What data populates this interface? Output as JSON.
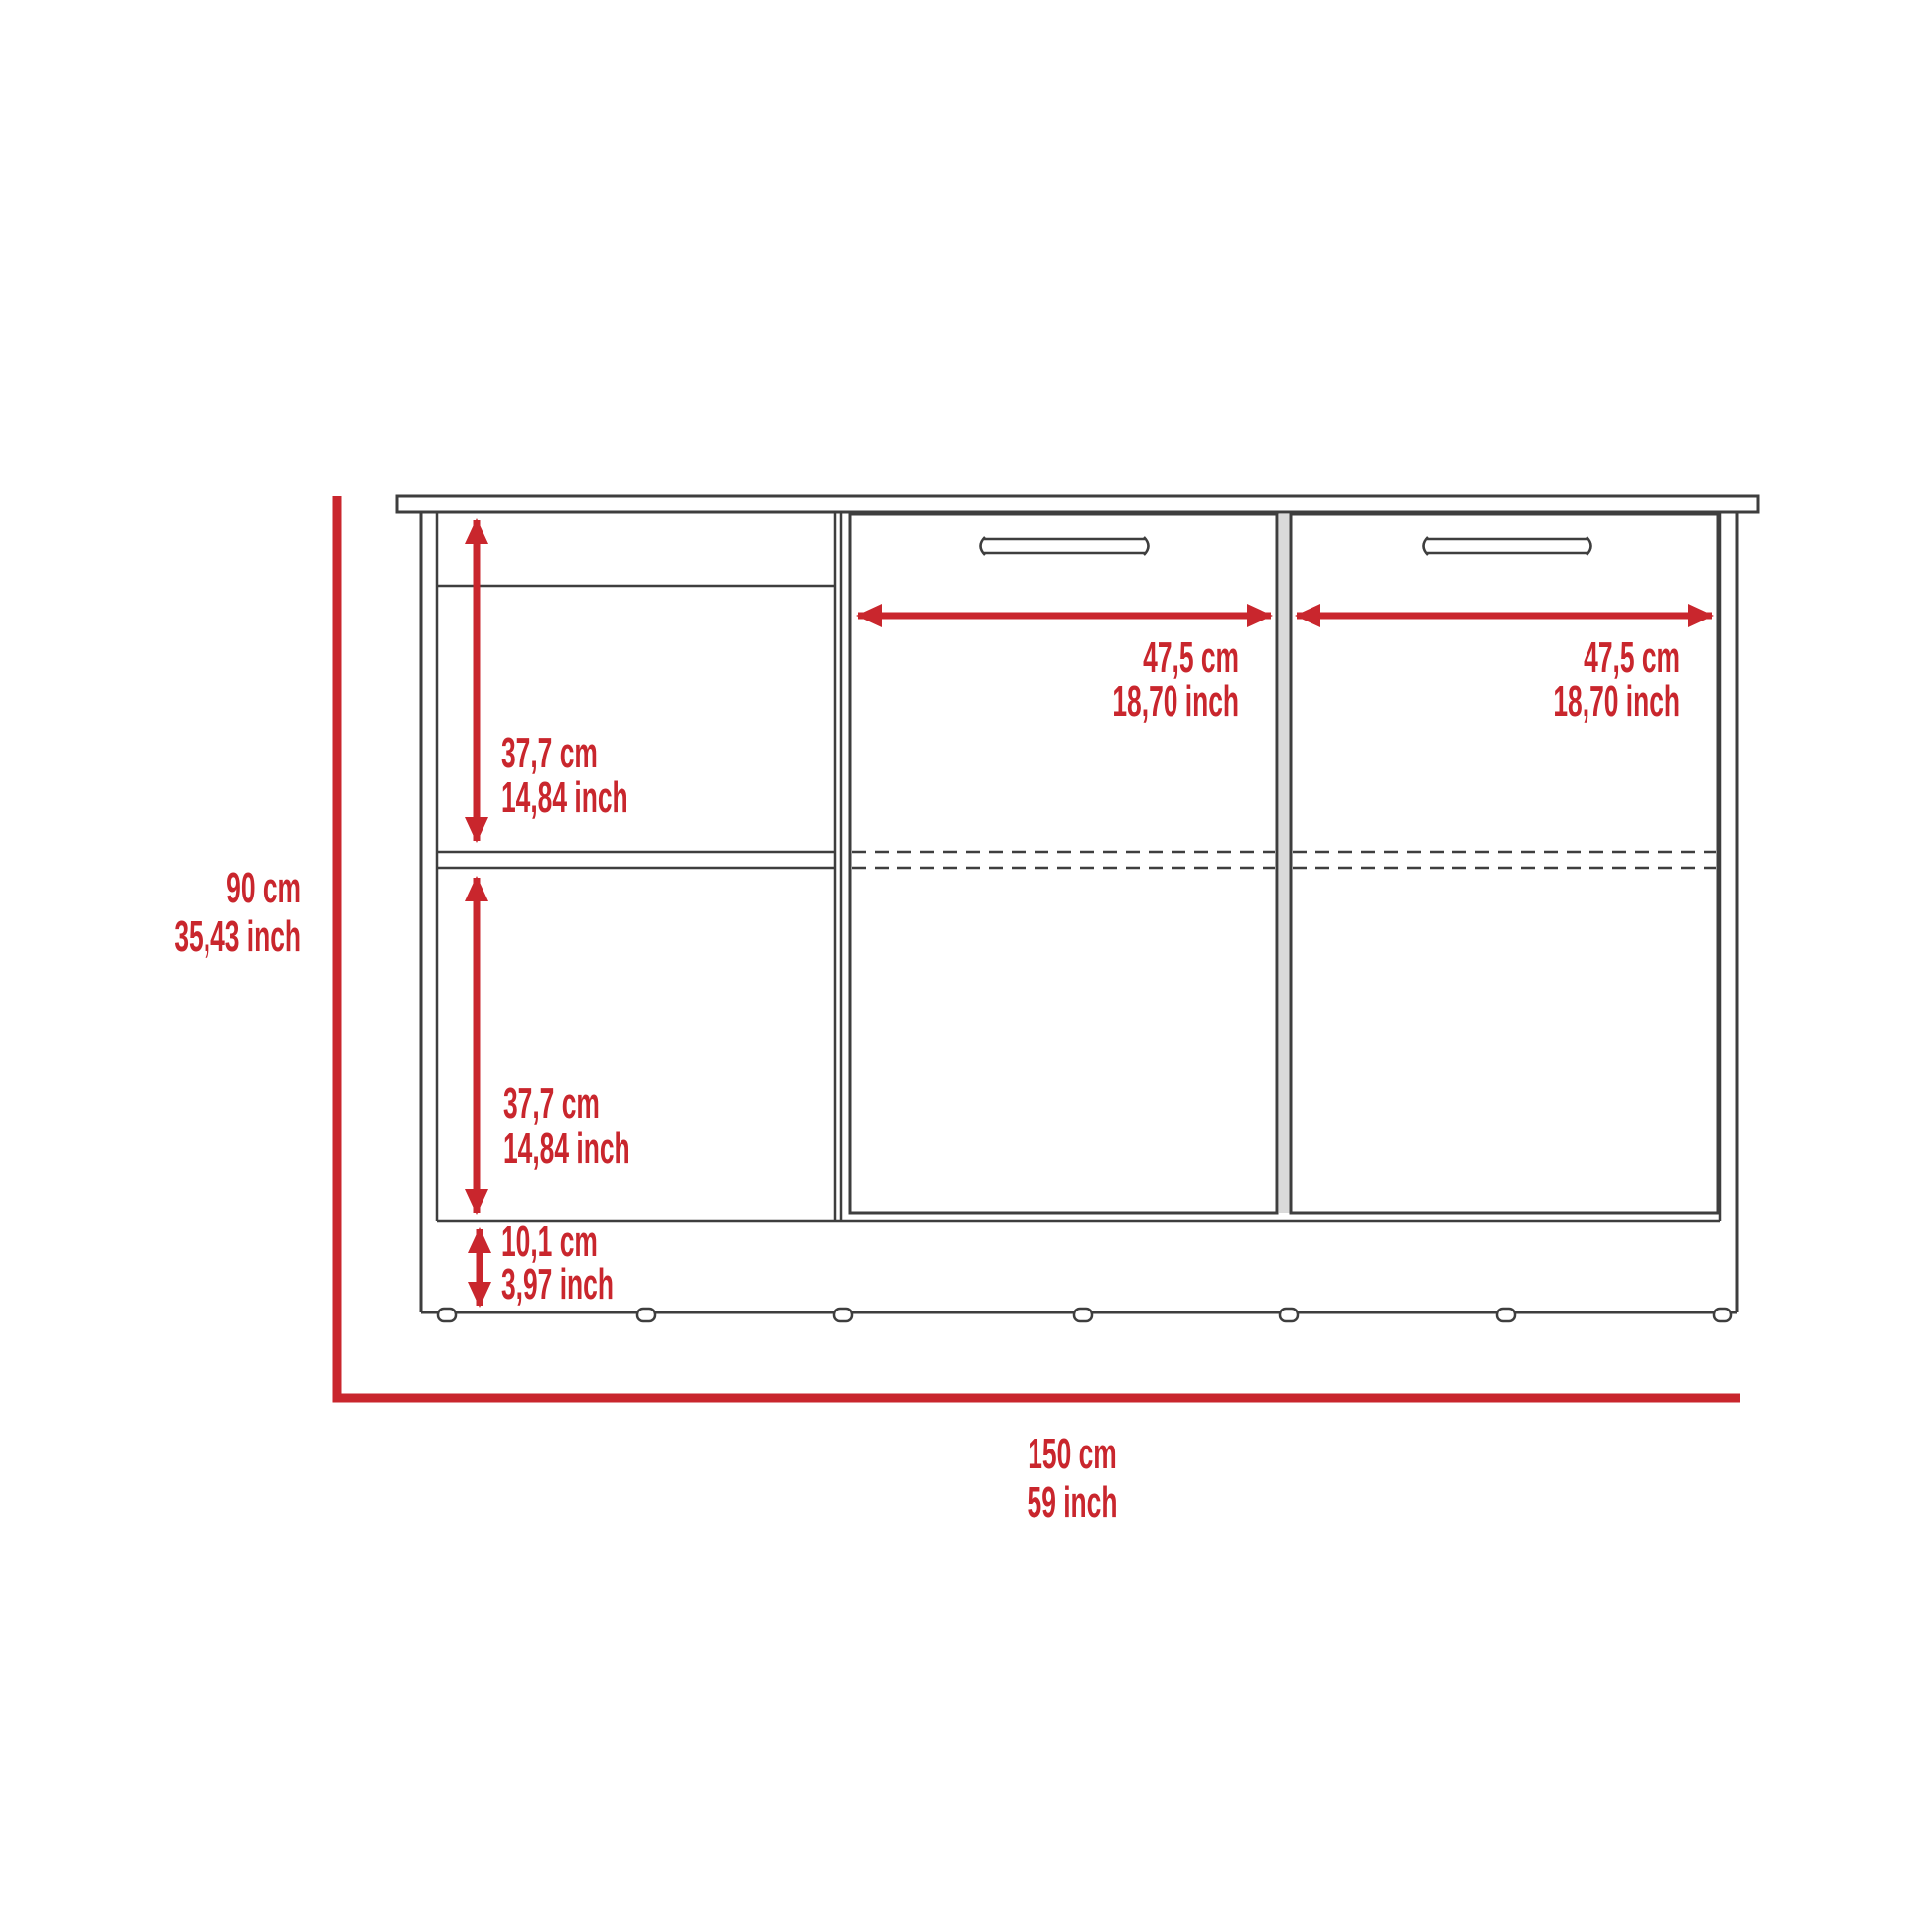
{
  "diagram": {
    "accent_color": "#c9262d",
    "line_color": "#3e3e3e",
    "labels": {
      "overall_height": {
        "cm": "90 cm",
        "inch": "35,43 inch"
      },
      "overall_width": {
        "cm": "150 cm",
        "inch": "59 inch"
      },
      "upper_shelf_height": {
        "cm": "37,7 cm",
        "inch": "14,84 inch"
      },
      "lower_shelf_height": {
        "cm": "37,7 cm",
        "inch": "14,84 inch"
      },
      "base_height": {
        "cm": "10,1 cm",
        "inch": "3,97 inch"
      },
      "left_door_width": {
        "cm": "47,5 cm",
        "inch": "18,70 inch"
      },
      "right_door_width": {
        "cm": "47,5 cm",
        "inch": "18,70 inch"
      }
    }
  }
}
